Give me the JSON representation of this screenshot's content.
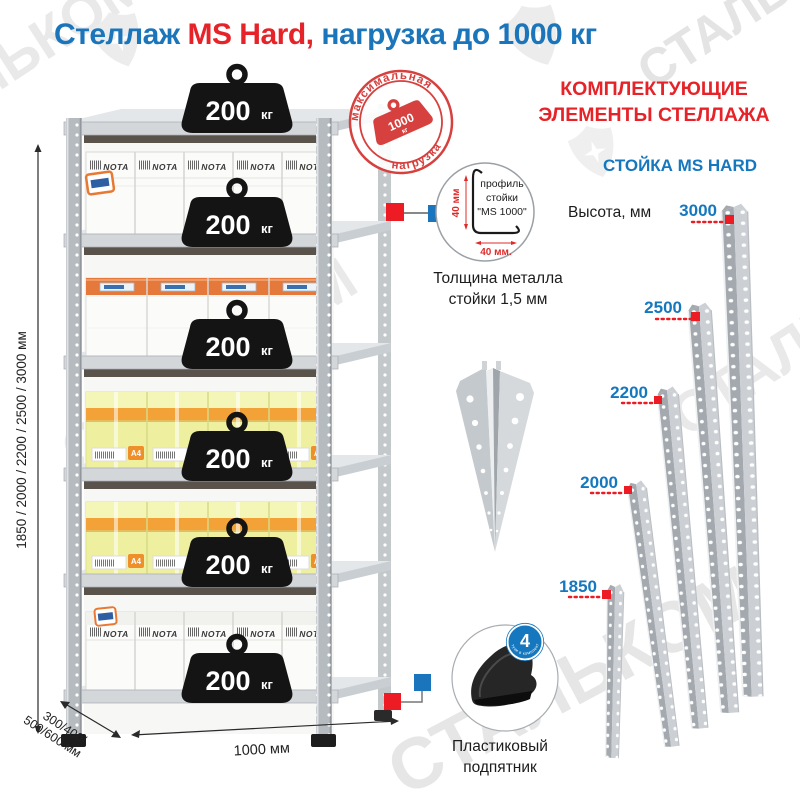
{
  "colors": {
    "blue": "#1b75bb",
    "red": "#e52328",
    "label_blue": "#1577be",
    "marker_red": "#ed1c24"
  },
  "watermark": {
    "text": "СТАЛЬКОМ"
  },
  "header": {
    "title_1": "Стеллаж ",
    "title_2": "MS Hard,",
    "title_3": " нагрузка до 1000 кг"
  },
  "rack": {
    "weight_value": "200",
    "weight_unit": "кг",
    "stamp": {
      "top": "максимальная",
      "bottom": "нагрузка",
      "value": "1000",
      "unit": "кг"
    },
    "box_brand": "NOTA",
    "box_size": "A4",
    "dim_height": "1850 / 2000 / 2200 / 2500 / 3000 мм",
    "dim_depth_1": "300/400/",
    "dim_depth_2": "500/600 мм",
    "dim_width": "1000 мм"
  },
  "profile": {
    "label_1": "профиль",
    "label_2": "стойки",
    "label_3": "\"MS 1000\"",
    "dim_vertical": "40 мм",
    "dim_horizontal": "40 мм.",
    "thickness_1": "Толщина металла",
    "thickness_2": "стойки 1,5 мм"
  },
  "foot": {
    "badge_value": "4",
    "badge_text": "штуки в комплекте",
    "label_1": "Пластиковый",
    "label_2": "подпятник"
  },
  "components": {
    "heading_1": "КОМПЛЕКТУЮЩИЕ",
    "heading_2": "ЭЛЕМЕНТЫ СТЕЛЛАЖА",
    "subheading": "СТОЙКА MS HARD",
    "height_label": "Высота, мм",
    "posts": [
      {
        "height": "1850"
      },
      {
        "height": "2000"
      },
      {
        "height": "2200"
      },
      {
        "height": "2500"
      },
      {
        "height": "3000"
      }
    ]
  }
}
